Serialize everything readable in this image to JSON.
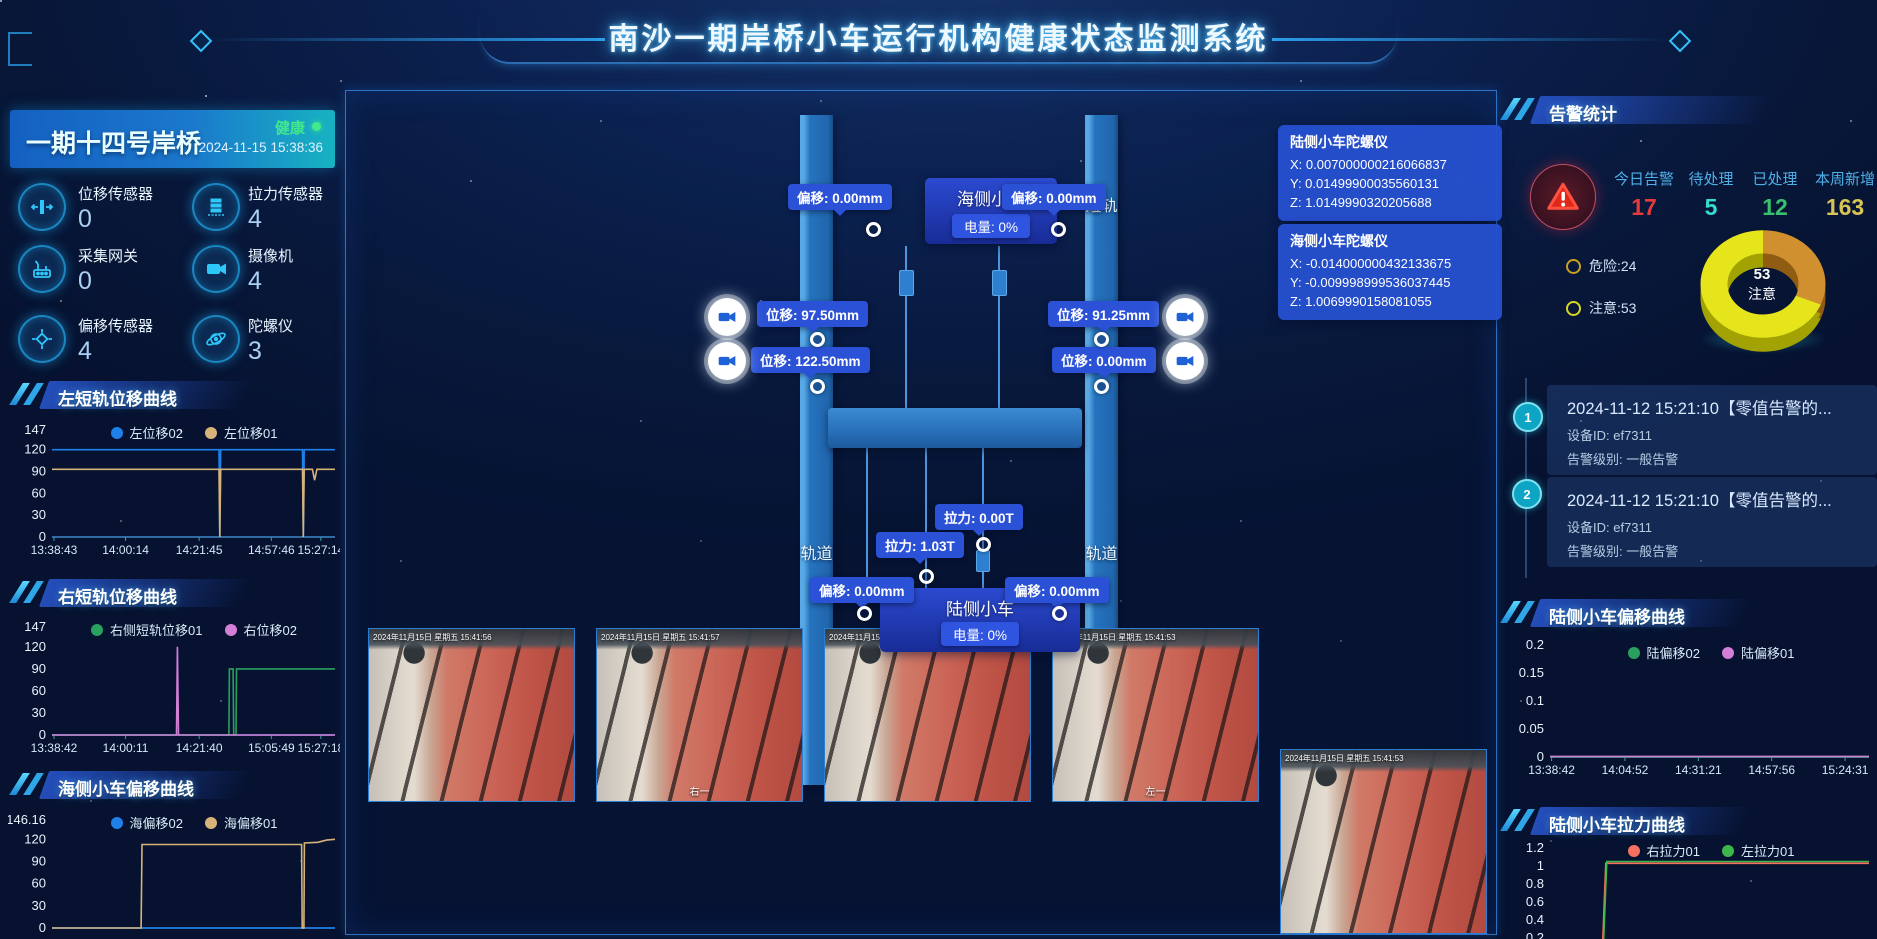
{
  "header": {
    "title": "南沙一期岸桥小车运行机构健康状态监测系统"
  },
  "left_panel": {
    "crane_name": "一期十四号岸桥",
    "status": "健康",
    "timestamp": "2024-11-15 15:38:36",
    "sensors": [
      {
        "label": "位移传感器",
        "value": "0"
      },
      {
        "label": "拉力传感器",
        "value": "4"
      },
      {
        "label": "采集网关",
        "value": "0"
      },
      {
        "label": "摄像机",
        "value": "4"
      },
      {
        "label": "偏移传感器",
        "value": "4"
      },
      {
        "label": "陀螺仪",
        "value": "3"
      }
    ]
  },
  "center": {
    "rails": {
      "top_left": "短轨",
      "top_right": "短轨",
      "bottom_left": "轨道",
      "bottom_right": "轨道"
    },
    "sea_trolley": {
      "name": "海侧小车",
      "battery": "电量: 0%",
      "offset_left": "偏移: 0.00mm",
      "offset_right": "偏移: 0.00mm"
    },
    "land_trolley": {
      "name": "陆侧小车",
      "battery": "电量: 0%",
      "offset_left": "偏移: 0.00mm",
      "offset_right": "偏移: 0.00mm"
    },
    "displacement_tips": {
      "left_top": "位移: 97.50mm",
      "left_bottom": "位移: 122.50mm",
      "right_top": "位移: 91.25mm",
      "right_bottom": "位移: 0.00mm"
    },
    "tension_tips": {
      "top": "拉力: 0.00T",
      "bottom": "拉力: 1.03T"
    },
    "gyros": [
      {
        "title": "陆侧小车陀螺仪",
        "x": "X: 0.007000000216066837",
        "y": "Y: 0.01499900035560131",
        "z": "Z: 1.0149990320205688"
      },
      {
        "title": "海侧小车陀螺仪",
        "x": "X: -0.014000000432133675",
        "y": "Y: -0.009998999536037445",
        "z": "Z: 1.0069990158081055"
      }
    ],
    "cameras": [
      {
        "timestamp": "2024年11月15日 星期五 15:41:56",
        "caption": ""
      },
      {
        "timestamp": "2024年11月15日 星期五 15:41:57",
        "caption": "右一"
      },
      {
        "timestamp": "2024年11月15日 星期五 15:41:51",
        "caption": ""
      },
      {
        "timestamp": "2024年11月15日 星期五 15:41:53",
        "caption": "左一"
      },
      {
        "timestamp": "2024年11月15日 星期五 15:41:53",
        "caption": ""
      }
    ]
  },
  "right_panel": {
    "alarm_title": "告警统计",
    "stats": [
      {
        "label": "今日告警",
        "value": "17",
        "color": "#e83a3a"
      },
      {
        "label": "待处理",
        "value": "5",
        "color": "#35dcd0"
      },
      {
        "label": "已处理",
        "value": "12",
        "color": "#38c06e"
      },
      {
        "label": "本周新增",
        "value": "163",
        "color": "#d8c455"
      }
    ],
    "donut_center": {
      "value": "53",
      "label": "注意"
    },
    "donut_legend": [
      "危险:24",
      "注意:53"
    ],
    "alarms": [
      {
        "index": "1",
        "title": "2024-11-12 15:21:10【零值告警的...",
        "device": "设备ID: ef7311",
        "level": "告警级别: 一般告警"
      },
      {
        "index": "2",
        "title": "2024-11-12 15:21:10【零值告警的...",
        "device": "设备ID: ef7311",
        "level": "告警级别: 一般告警"
      }
    ]
  },
  "chart_data": [
    {
      "type": "line",
      "title": "左短轨位移曲线",
      "ylabel": "",
      "xlabel": "",
      "ylim": [
        0,
        147
      ],
      "yticks": [
        147,
        120,
        90,
        60,
        30,
        0
      ],
      "grid": false,
      "legend_position": "top",
      "x_ticks": [
        "13:38:43",
        "14:00:14",
        "14:21:45",
        "14:57:46",
        "15:27:14"
      ],
      "xtick_fracs": [
        0.007,
        0.26,
        0.52,
        0.775,
        0.95
      ],
      "series": [
        {
          "name": "左位移02",
          "color": "#1e80e8",
          "points": [
            [
              0,
              120
            ],
            [
              0.59,
              120
            ],
            [
              0.593,
              0
            ],
            [
              0.596,
              120
            ],
            [
              0.885,
              120
            ],
            [
              0.888,
              0
            ],
            [
              0.891,
              120
            ],
            [
              1,
              120
            ]
          ]
        },
        {
          "name": "左位移01",
          "color": "#d7b379",
          "points": [
            [
              0,
              93
            ],
            [
              0.59,
              93
            ],
            [
              0.593,
              0
            ],
            [
              0.596,
              93
            ],
            [
              0.885,
              93
            ],
            [
              0.888,
              0
            ],
            [
              0.891,
              93
            ],
            [
              0.92,
              93
            ],
            [
              0.928,
              78
            ],
            [
              0.936,
              93
            ],
            [
              1,
              93
            ]
          ]
        }
      ]
    },
    {
      "type": "line",
      "title": "右短轨位移曲线",
      "ylim": [
        0,
        147
      ],
      "yticks": [
        147,
        120,
        90,
        60,
        30,
        0
      ],
      "grid": false,
      "x_ticks": [
        "13:38:42",
        "14:00:11",
        "14:21:40",
        "15:05:49",
        "15:27:18"
      ],
      "xtick_fracs": [
        0.007,
        0.26,
        0.52,
        0.775,
        0.95
      ],
      "series": [
        {
          "name": "右侧短轨位移01",
          "color": "#2aa05f",
          "points": [
            [
              0,
              0
            ],
            [
              0.625,
              0
            ],
            [
              0.627,
              90
            ],
            [
              0.64,
              90
            ],
            [
              0.642,
              0
            ],
            [
              0.65,
              0
            ],
            [
              0.652,
              90
            ],
            [
              1,
              90
            ]
          ]
        },
        {
          "name": "右位移02",
          "color": "#d27fd8",
          "points": [
            [
              0,
              0
            ],
            [
              0.44,
              0
            ],
            [
              0.443,
              120
            ],
            [
              0.447,
              0
            ],
            [
              1,
              0
            ]
          ]
        }
      ]
    },
    {
      "type": "line",
      "title": "海侧小车偏移曲线",
      "ylim": [
        0,
        146.16
      ],
      "yticks": [
        146.16,
        120,
        90,
        60,
        30,
        0
      ],
      "grid": false,
      "x_ticks": [],
      "xtick_fracs": [],
      "series": [
        {
          "name": "海偏移02",
          "color": "#1e80e8",
          "points": [
            [
              0,
              0
            ],
            [
              1,
              0
            ]
          ]
        },
        {
          "name": "海偏移01",
          "color": "#d7b379",
          "points": [
            [
              0,
              0
            ],
            [
              0.315,
              0
            ],
            [
              0.318,
              113
            ],
            [
              0.882,
              113
            ],
            [
              0.884,
              0
            ],
            [
              0.89,
              0
            ],
            [
              0.892,
              115
            ],
            [
              0.94,
              116
            ],
            [
              0.97,
              119
            ],
            [
              1,
              120
            ]
          ]
        }
      ]
    },
    {
      "type": "line",
      "title": "陆侧小车偏移曲线",
      "ylim": [
        0,
        0.2
      ],
      "yticks": [
        0.2,
        0.15,
        0.1,
        0.05,
        0
      ],
      "grid": false,
      "x_ticks": [
        "13:38:42",
        "14:04:52",
        "14:31:21",
        "14:57:56",
        "15:24:31"
      ],
      "xtick_fracs": [
        0.005,
        0.235,
        0.465,
        0.695,
        0.925
      ],
      "series": [
        {
          "name": "陆偏移02",
          "color": "#2aa05f",
          "points": [
            [
              0,
              0
            ],
            [
              1,
              0
            ]
          ]
        },
        {
          "name": "陆偏移01",
          "color": "#d27fd8",
          "points": [
            [
              0,
              0.001
            ],
            [
              1,
              0.001
            ]
          ]
        }
      ]
    },
    {
      "type": "line",
      "title": "陆侧小车拉力曲线",
      "ylim": [
        0,
        1.2
      ],
      "yticks": [
        1.2,
        1,
        0.8,
        0.6,
        0.4,
        0.2
      ],
      "axis": false,
      "grid": false,
      "x_ticks": [],
      "xtick_fracs": [],
      "series": [
        {
          "name": "右拉力01",
          "color": "#f87060",
          "points": [
            [
              0,
              0.13
            ],
            [
              0.165,
              0.13
            ],
            [
              0.175,
              1.03
            ],
            [
              1,
              1.03
            ]
          ]
        },
        {
          "name": "左拉力01",
          "color": "#3cb84a",
          "points": [
            [
              0,
              0.16
            ],
            [
              0.168,
              0.16
            ],
            [
              0.178,
              1.05
            ],
            [
              1,
              1.05
            ]
          ]
        }
      ]
    },
    {
      "type": "pie",
      "title": "告警分布",
      "labels": [
        "危险",
        "注意"
      ],
      "values": [
        24,
        53
      ],
      "colors": [
        "#d09030",
        "#e6e51c"
      ],
      "depth_colors": [
        "#8f5c12",
        "#a2a202"
      ]
    }
  ]
}
